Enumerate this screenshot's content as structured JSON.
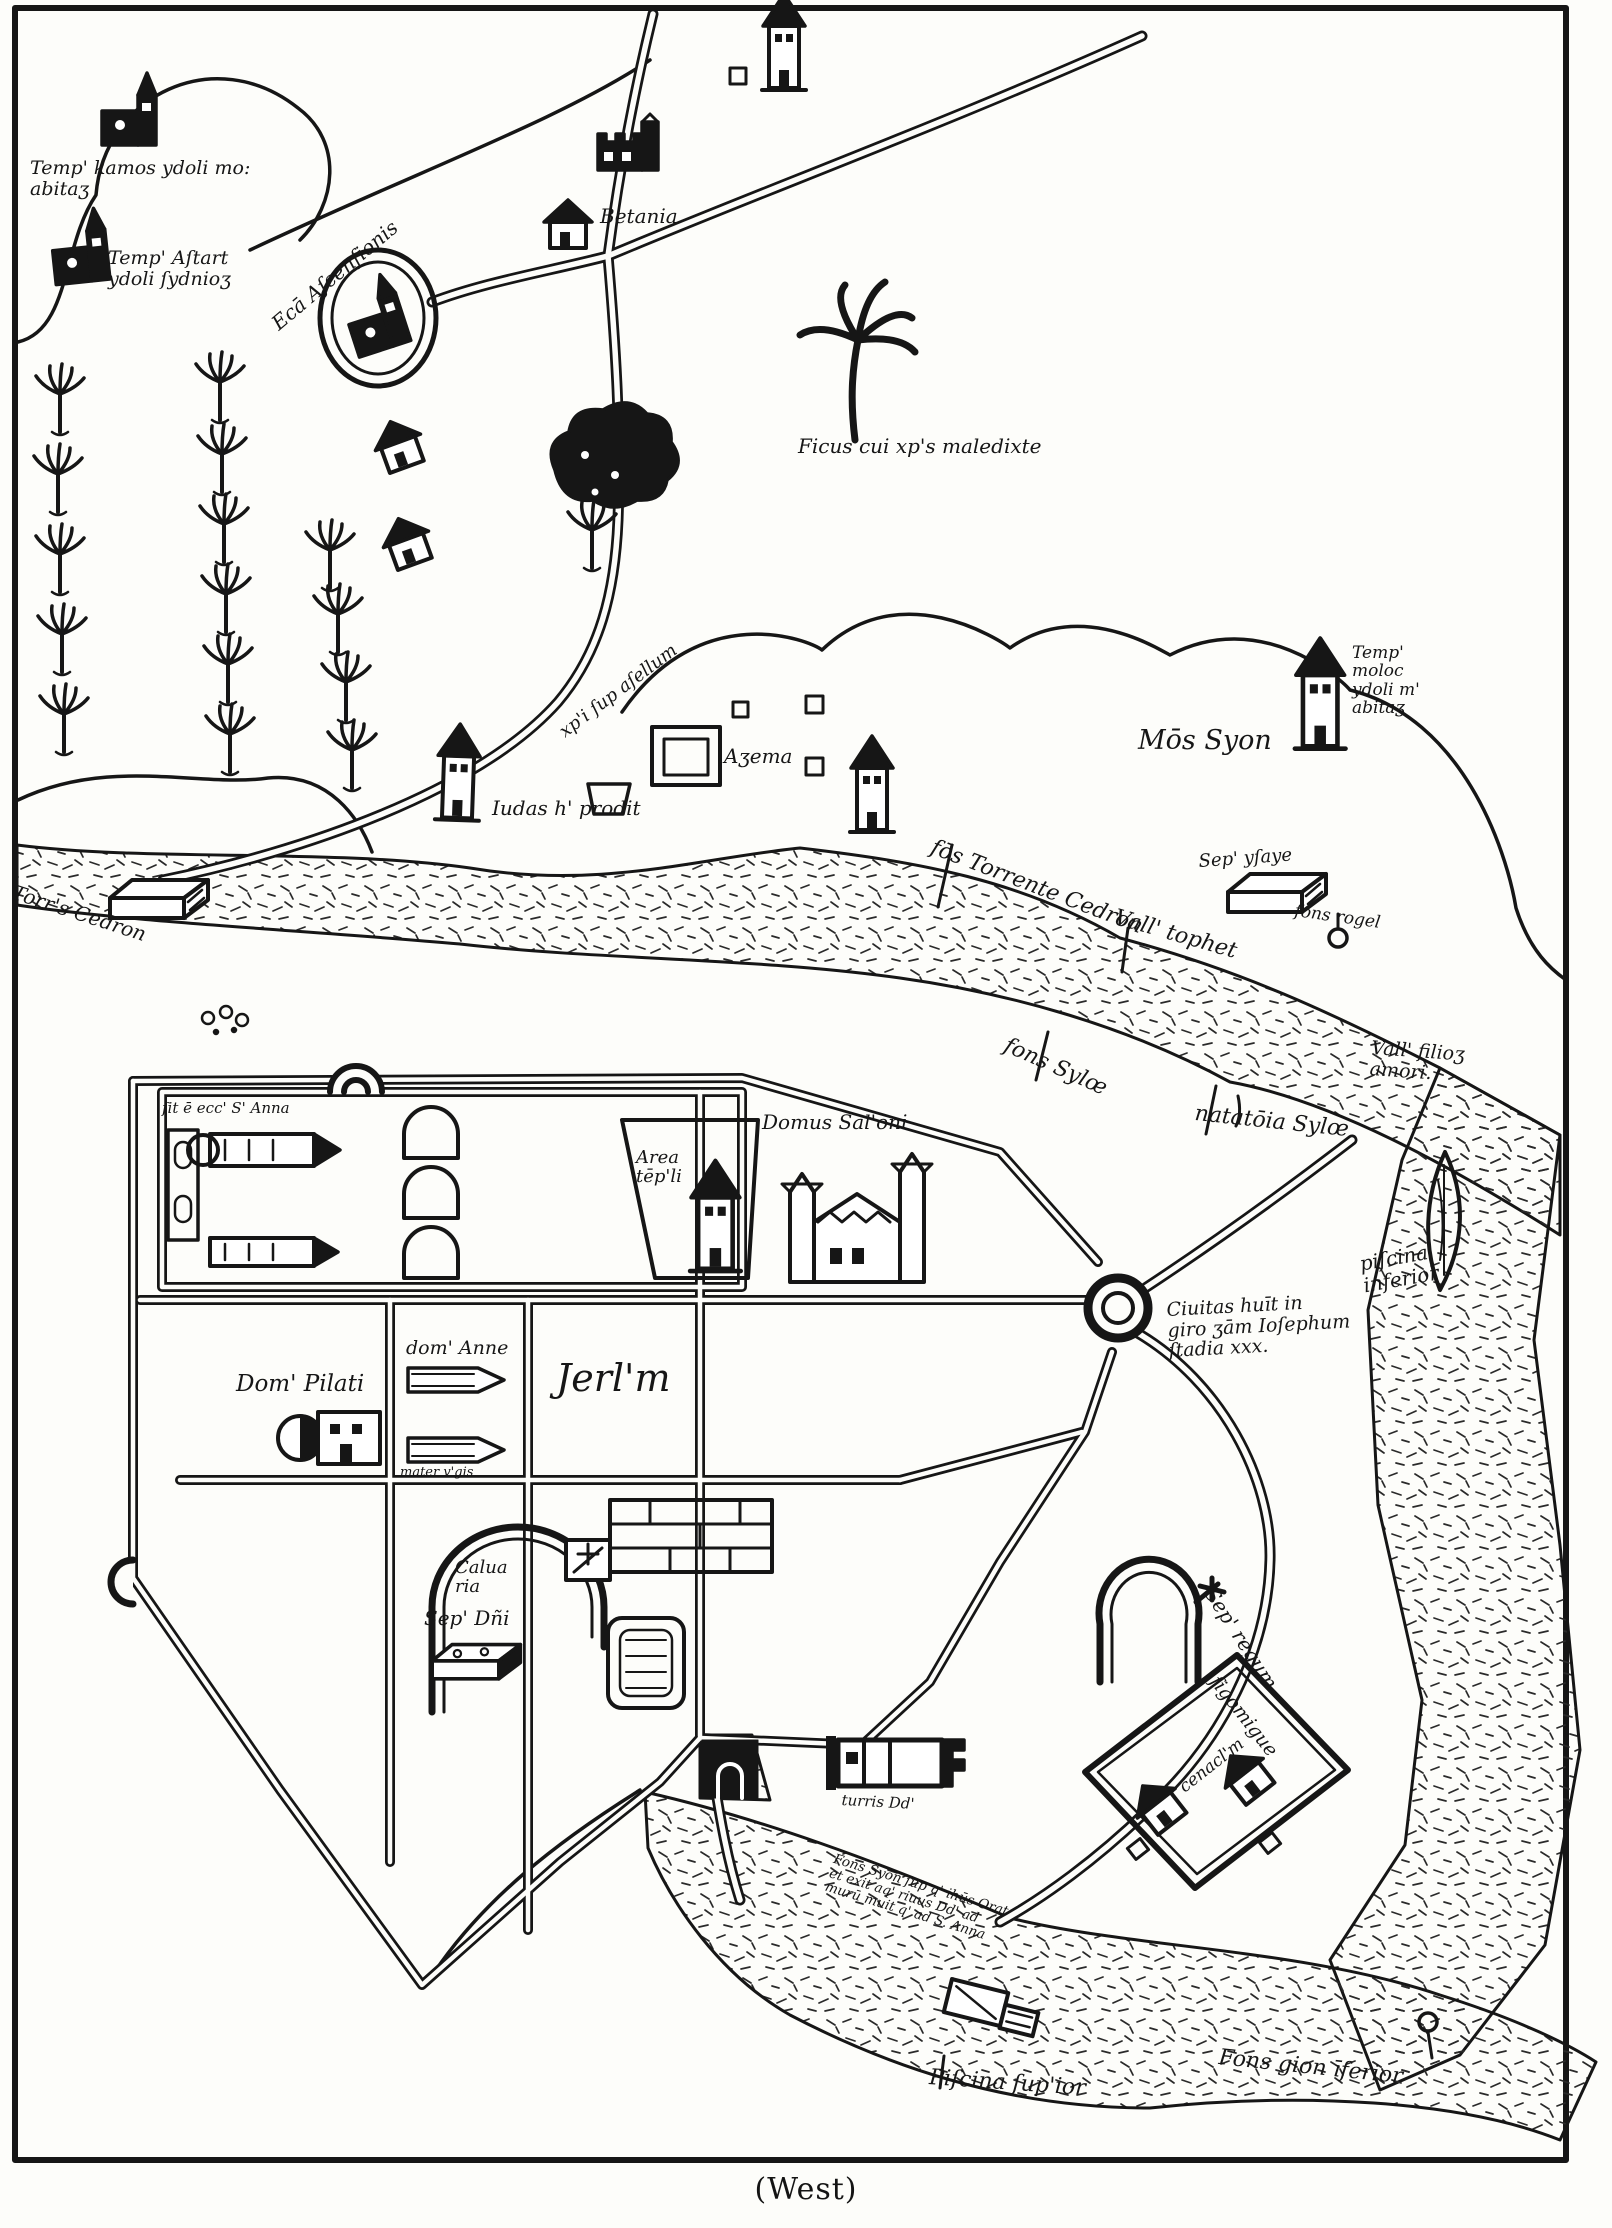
{
  "caption": {
    "text": "(West)"
  },
  "labels": {
    "temp_kamos": {
      "text": "Temp' kamos ydoli mo:\nabitaʒ"
    },
    "temp_astart": {
      "text": "Temp' Aſtart\nydoli ſydnioʒ"
    },
    "ecca_ascensionis": {
      "text": "Ecā Aſcenſionis"
    },
    "betania": {
      "text": "Betania"
    },
    "ficus": {
      "text": "Ficus cui xp's maledixte"
    },
    "via_asellum": {
      "text": "xp'i ſup aſellum"
    },
    "iudas": {
      "text": "Iudas h' prodit"
    },
    "azema": {
      "text": "Aʒema"
    },
    "mons_syon": {
      "text": "Mōs Syon"
    },
    "temp_moloc": {
      "text": "Temp'\nmoloc\nydoli m'\nabitaʒ"
    },
    "fons_torrente": {
      "text": "fōs Torrente Cedron"
    },
    "vall_tophet": {
      "text": "Vall' tophet"
    },
    "sep_ysaye": {
      "text": "Sep' yſaye"
    },
    "fons_rogel": {
      "text": "fons rogel"
    },
    "torrens_cedron": {
      "text": "Torr's Cedron"
    },
    "fons_sylo": {
      "text": "fons Sylœ"
    },
    "natatoria_sylo": {
      "text": "natatōia Sylœ"
    },
    "vall_filio": {
      "text": "Vall' filioʒ\namori."
    },
    "piscina_inferior": {
      "text": "piſcina\ninferior"
    },
    "ecc_s_anna": {
      "text": "ſit ē ecc' S' Anna"
    },
    "area_templi": {
      "text": "Area\ntēp'li"
    },
    "domus_salomonis": {
      "text": "Domus Sal'oni"
    },
    "dom_anne": {
      "text": "dom' Anne"
    },
    "dom_pilati": {
      "text": "Dom' Pilati"
    },
    "jerusalem": {
      "text": "Jerl'm"
    },
    "mater_virginis": {
      "text": "mater v'gis"
    },
    "ciuitas_note": {
      "text": "Ciuitas huīt in\ngiro ʒām Ioſephum\nſtadia xxx."
    },
    "caluaria": {
      "text": "Calua\nria"
    },
    "sep_dni": {
      "text": "Sep' Dñi"
    },
    "sep_regum": {
      "text": "Sep' regum"
    },
    "sigomigue": {
      "text": "ſigomigue"
    },
    "cenaculum": {
      "text": "cenacl'm"
    },
    "turris_david": {
      "text": "turris Dd'"
    },
    "fons_syon_note": {
      "text": "Fons Syon ſup q' ihūs Orat\net exit aq' riuus Dd' ad\nmurū muit q' ad S. Anna"
    },
    "piscina_superior": {
      "text": "Piſcina ſup'ior"
    },
    "fons_gion": {
      "text": "Fons gion īferior"
    }
  }
}
